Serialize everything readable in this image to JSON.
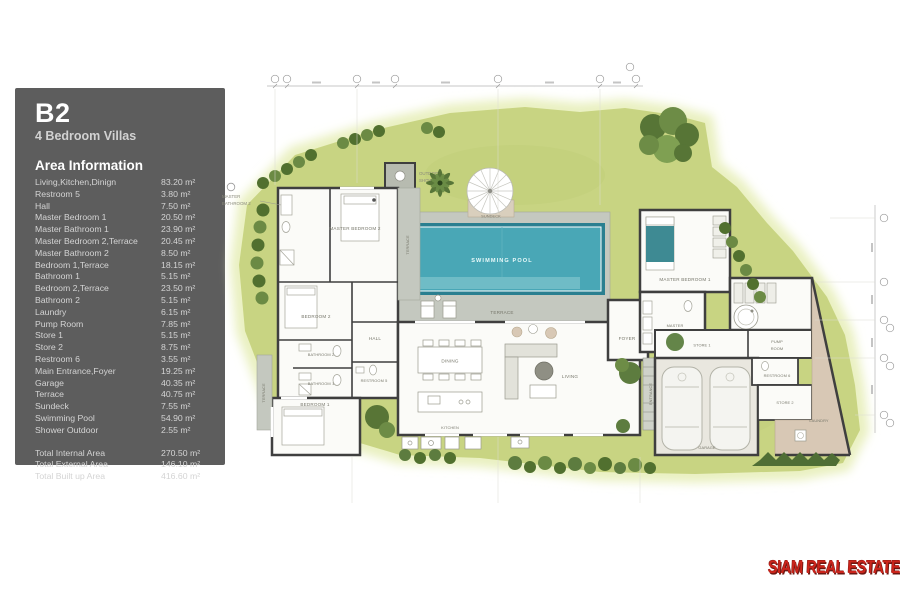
{
  "panel": {
    "title": "B2",
    "subtitle": "4 Bedroom Villas",
    "section_heading": "Area Information",
    "rows": [
      {
        "label": "Living,Kitchen,Dinign",
        "value": "83.20 m²"
      },
      {
        "label": "Restroom 5",
        "value": "3.80 m²"
      },
      {
        "label": "Hall",
        "value": "7.50 m²"
      },
      {
        "label": "Master Bedroom 1",
        "value": "20.50 m²"
      },
      {
        "label": "Master Bathroom 1",
        "value": "23.90 m²"
      },
      {
        "label": "Master Bedroom 2,Terrace",
        "value": "20.45 m²"
      },
      {
        "label": "Master Bathroom 2",
        "value": "8.50 m²"
      },
      {
        "label": "Bedroom 1,Terrace",
        "value": "18.15 m²"
      },
      {
        "label": "Bathroom 1",
        "value": "5.15 m²"
      },
      {
        "label": "Bedroom 2,Terrace",
        "value": "23.50 m²"
      },
      {
        "label": "Bathroom 2",
        "value": "5.15 m²"
      },
      {
        "label": "Laundry",
        "value": "6.15 m²"
      },
      {
        "label": "Pump Room",
        "value": "7.85 m²"
      },
      {
        "label": "Store 1",
        "value": "5.15 m²"
      },
      {
        "label": "Store 2",
        "value": "8.75 m²"
      },
      {
        "label": "Restroom 6",
        "value": "3.55 m²"
      },
      {
        "label": "Main Entrance,Foyer",
        "value": "19.25 m²"
      },
      {
        "label": "Garage",
        "value": "40.35 m²"
      },
      {
        "label": "Terrace",
        "value": "40.75 m²"
      },
      {
        "label": "Sundeck",
        "value": "7.55 m²"
      },
      {
        "label": "Swimming Pool",
        "value": "54.90 m²"
      },
      {
        "label": "Shower Outdoor",
        "value": "2.55 m²"
      }
    ],
    "totals": [
      {
        "label": "Total Internal Area",
        "value": "270.50 m²"
      },
      {
        "label": "Total External Area",
        "value": "146.10 m²"
      },
      {
        "label": "Total Built up Area",
        "value": "416.60 m²"
      }
    ]
  },
  "plan": {
    "labels": {
      "outdoor_shower_line1": "OUTDOOR",
      "outdoor_shower_line2": "SHOWER",
      "sundeck": "SUNDECK",
      "swimming_pool": "SWIMMING POOL",
      "terrace_pool": "TERRACE",
      "terrace_mb2": "TERRACE",
      "terrace_bed1": "TERRACE",
      "master_bathroom2_line1": "MASTER",
      "master_bathroom2_line2": "BATHROOM 2",
      "master_bedroom2": "MASTER BEDROOM 2",
      "bedroom2": "BEDROOM 2",
      "bathroom2": "BATHROOM 2",
      "bathroom1": "BATHROOM 1",
      "bedroom1": "BEDROOM 1",
      "hall": "HALL",
      "restroom5": "RESTROOM 5",
      "dining": "DINING",
      "kitchen": "KITCHEN",
      "living": "LIVING",
      "foyer": "FOYER",
      "entrance": "ENTRANCE",
      "master_bedroom1": "MASTER BEDROOM 1",
      "master_bathroom1_line1": "MASTER",
      "master_bathroom1_line2": "BATHROOM 1",
      "store1": "STORE 1",
      "pump_line1": "PUMP",
      "pump_line2": "ROOM",
      "restroom6": "RESTROOM 6",
      "store2": "STORE 2",
      "laundry": "LAUNDRY",
      "garage": "GARAGE"
    }
  },
  "logo": {
    "text": "SIAM REAL ESTATE"
  },
  "colors": {
    "panel_bg": "#5d5d5d",
    "grass": "#c8d482",
    "grass_glow": "#e9f0c0",
    "pool": "#3d9fae",
    "deck": "#c4c8bf",
    "wall": "#3f3f3f",
    "tan": "#d8c8b5",
    "logo_red": "#cc241b"
  }
}
